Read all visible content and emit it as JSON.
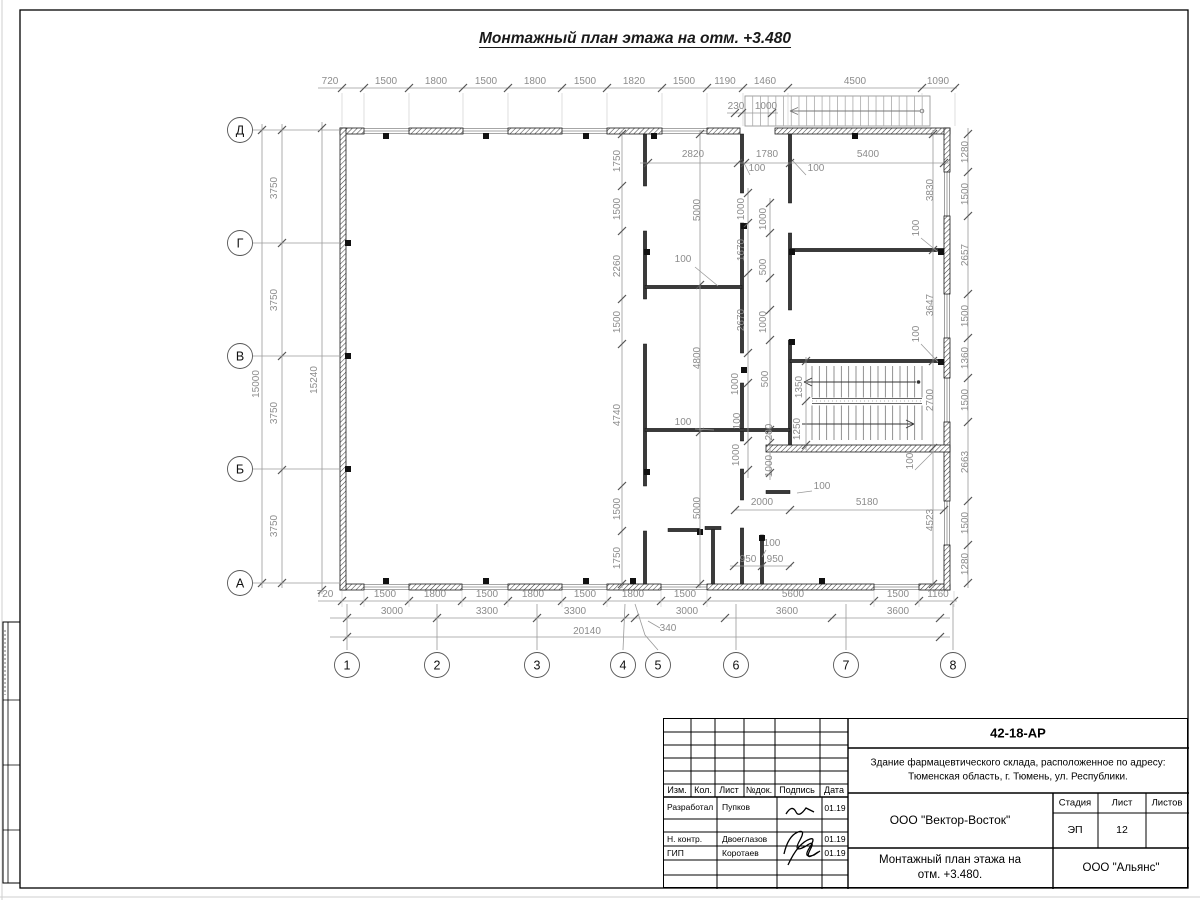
{
  "meta": {
    "title": "Монтажный план этажа на отм. +3.480"
  },
  "titleblock": {
    "code": "42-18-АР",
    "object1": "Здание фармацевтического склада, расположенное по адресу:",
    "object2": "Тюменская область, г. Тюмень, ул. Республики.",
    "cols": [
      "Изм.",
      "Кол.",
      "Лист",
      "№док.",
      "Подпись",
      "Дата"
    ],
    "sign_rows": [
      {
        "role": "Разработал",
        "name": "Пупков",
        "date": "01.19"
      },
      {
        "role": "Н. контр.",
        "name": "Двоеглазов",
        "date": "01.19"
      },
      {
        "role": "ГИП",
        "name": "Коротаев",
        "date": "01.19"
      }
    ],
    "org": "ООО \"Вектор-Восток\"",
    "stage_label": "Стадия",
    "sheet_label": "Лист",
    "sheets_label": "Листов",
    "stage": "ЭП",
    "sheet": "12",
    "sheets": "",
    "name1": "Монтажный план этажа на",
    "name2": "отм. +3.480.",
    "company": "ООО \"Альянс\""
  },
  "plan": {
    "colors": {
      "wall": "#1a1a1a",
      "dim": "#8c8c8c",
      "line": "#9a9a9a",
      "tick": "#555555",
      "thin": "#888888"
    },
    "frame": {
      "x": 20,
      "y": 10,
      "w": 1168,
      "h": 878
    },
    "ext_walls": [
      [
        340,
        128,
        24,
        6
      ],
      [
        409,
        128,
        54,
        6
      ],
      [
        508,
        128,
        54,
        6
      ],
      [
        607,
        128,
        55,
        6
      ],
      [
        707,
        128,
        33,
        6
      ],
      [
        775,
        128,
        175,
        6
      ],
      [
        340,
        584,
        24,
        6
      ],
      [
        409,
        584,
        53,
        6
      ],
      [
        508,
        584,
        54,
        6
      ],
      [
        607,
        584,
        54,
        6
      ],
      [
        707,
        584,
        167,
        6
      ],
      [
        919,
        584,
        31,
        6
      ],
      [
        340,
        128,
        6,
        462
      ],
      [
        944,
        128,
        6,
        44
      ],
      [
        944,
        216,
        6,
        78
      ],
      [
        944,
        338,
        6,
        40
      ],
      [
        944,
        422,
        6,
        79
      ],
      [
        944,
        545,
        6,
        45
      ],
      [
        766,
        445,
        184,
        7
      ]
    ],
    "windows": [
      [
        364,
        128,
        45,
        6,
        "h"
      ],
      [
        463,
        128,
        45,
        6,
        "h"
      ],
      [
        562,
        128,
        45,
        6,
        "h"
      ],
      [
        662,
        128,
        45,
        6,
        "h"
      ],
      [
        364,
        584,
        45,
        6,
        "h"
      ],
      [
        462,
        584,
        46,
        6,
        "h"
      ],
      [
        562,
        584,
        45,
        6,
        "h"
      ],
      [
        661,
        584,
        46,
        6,
        "h"
      ],
      [
        874,
        584,
        45,
        6,
        "h"
      ],
      [
        944,
        172,
        6,
        44,
        "v"
      ],
      [
        944,
        294,
        6,
        44,
        "v"
      ],
      [
        944,
        378,
        6,
        44,
        "v"
      ],
      [
        944,
        501,
        6,
        44,
        "v"
      ]
    ],
    "int_walls_v": [
      [
        645,
        134,
        186
      ],
      [
        645,
        231,
        299
      ],
      [
        645,
        344,
        486
      ],
      [
        645,
        531,
        584
      ],
      [
        742,
        134,
        193
      ],
      [
        742,
        223,
        353
      ],
      [
        742,
        383,
        441
      ],
      [
        742,
        469,
        500
      ],
      [
        742,
        528,
        584
      ],
      [
        790,
        134,
        203
      ],
      [
        790,
        233,
        310
      ],
      [
        790,
        340,
        445
      ],
      [
        713,
        528,
        584
      ],
      [
        762,
        535,
        584
      ]
    ],
    "int_walls_h": [
      [
        287,
        645,
        742
      ],
      [
        430,
        645,
        790
      ],
      [
        250,
        790,
        944
      ],
      [
        361,
        790,
        944
      ],
      [
        492,
        766,
        790
      ],
      [
        530,
        668,
        700
      ],
      [
        528,
        705,
        721
      ]
    ],
    "stubs": [
      [
        386,
        136
      ],
      [
        486,
        136
      ],
      [
        586,
        136
      ],
      [
        654,
        136
      ],
      [
        855,
        136
      ],
      [
        386,
        581
      ],
      [
        486,
        581
      ],
      [
        586,
        581
      ],
      [
        633,
        581
      ],
      [
        822,
        581
      ],
      [
        348,
        243
      ],
      [
        348,
        356
      ],
      [
        348,
        469
      ],
      [
        941,
        252
      ],
      [
        941,
        362
      ],
      [
        647,
        252
      ],
      [
        647,
        472
      ],
      [
        744,
        226
      ],
      [
        744,
        370
      ],
      [
        792,
        252
      ],
      [
        792,
        342
      ],
      [
        700,
        532
      ],
      [
        762,
        538
      ]
    ],
    "axis_rows": [
      [
        "Д",
        130
      ],
      [
        "Г",
        243
      ],
      [
        "В",
        356
      ],
      [
        "Б",
        469
      ],
      [
        "А",
        583
      ]
    ],
    "axis_cols": [
      [
        "1",
        347
      ],
      [
        "2",
        437
      ],
      [
        "3",
        537
      ],
      [
        "4",
        623
      ],
      [
        "5",
        658
      ],
      [
        "6",
        736
      ],
      [
        "7",
        846
      ],
      [
        "8",
        953
      ]
    ],
    "dims": [
      [
        "720",
        330,
        84
      ],
      [
        "1500",
        386,
        84
      ],
      [
        "1800",
        436,
        84
      ],
      [
        "1500",
        486,
        84
      ],
      [
        "1800",
        535,
        84
      ],
      [
        "1500",
        585,
        84
      ],
      [
        "1820",
        634,
        84
      ],
      [
        "1500",
        684,
        84
      ],
      [
        "1190",
        725,
        84
      ],
      [
        "1460",
        765,
        84
      ],
      [
        "4500",
        855,
        84
      ],
      [
        "1090",
        938,
        84
      ],
      [
        "230",
        736,
        109
      ],
      [
        "1000",
        766,
        109
      ],
      [
        "2820",
        693,
        157
      ],
      [
        "1780",
        767,
        157
      ],
      [
        "5400",
        868,
        157
      ],
      [
        "3750",
        277,
        188,
        1
      ],
      [
        "3750",
        277,
        300,
        1
      ],
      [
        "3750",
        277,
        413,
        1
      ],
      [
        "3750",
        277,
        526,
        1
      ],
      [
        "15000",
        259,
        384,
        1
      ],
      [
        "15240",
        317,
        380,
        1
      ],
      [
        "1750",
        620,
        161,
        1
      ],
      [
        "1500",
        620,
        209,
        1
      ],
      [
        "2260",
        620,
        266,
        1
      ],
      [
        "1500",
        620,
        322,
        1
      ],
      [
        "4740",
        620,
        415,
        1
      ],
      [
        "1500",
        620,
        509,
        1
      ],
      [
        "1750",
        620,
        558,
        1
      ],
      [
        "5000",
        700,
        210,
        1
      ],
      [
        "4800",
        700,
        358,
        1
      ],
      [
        "5000",
        700,
        508,
        1
      ],
      [
        "1000",
        744,
        209,
        1
      ],
      [
        "1000",
        766,
        219,
        1
      ],
      [
        "1670",
        744,
        250,
        1
      ],
      [
        "500",
        766,
        267,
        1
      ],
      [
        "2670",
        744,
        320,
        1
      ],
      [
        "1000",
        766,
        322,
        1
      ],
      [
        "1000",
        738,
        384,
        1
      ],
      [
        "500",
        768,
        379,
        1
      ],
      [
        "100",
        740,
        421,
        1
      ],
      [
        "200",
        772,
        432,
        1
      ],
      [
        "1000",
        739,
        455,
        1
      ],
      [
        "1000",
        772,
        466,
        1
      ],
      [
        "1350",
        802,
        387,
        1
      ],
      [
        "1250",
        800,
        429,
        1
      ],
      [
        "3830",
        933,
        190,
        1
      ],
      [
        "3647",
        933,
        305,
        1
      ],
      [
        "2700",
        933,
        400,
        1
      ],
      [
        "4523",
        933,
        520,
        1
      ],
      [
        "1280",
        968,
        152,
        1
      ],
      [
        "1500",
        968,
        194,
        1
      ],
      [
        "2657",
        968,
        255,
        1
      ],
      [
        "1500",
        968,
        316,
        1
      ],
      [
        "1360",
        968,
        358,
        1
      ],
      [
        "1500",
        968,
        400,
        1
      ],
      [
        "2663",
        968,
        462,
        1
      ],
      [
        "1500",
        968,
        523,
        1
      ],
      [
        "1280",
        968,
        564,
        1
      ],
      [
        "2000",
        762,
        505
      ],
      [
        "5180",
        867,
        505
      ],
      [
        "950",
        748,
        562
      ],
      [
        "950",
        775,
        562
      ],
      [
        "720",
        325,
        597
      ],
      [
        "1500",
        385,
        597
      ],
      [
        "1800",
        435,
        597
      ],
      [
        "1500",
        487,
        597
      ],
      [
        "1800",
        533,
        597
      ],
      [
        "1500",
        585,
        597
      ],
      [
        "1800",
        633,
        597
      ],
      [
        "1500",
        685,
        597
      ],
      [
        "5600",
        793,
        597
      ],
      [
        "1500",
        898,
        597
      ],
      [
        "1160",
        938,
        597
      ],
      [
        "3000",
        392,
        614
      ],
      [
        "3300",
        487,
        614
      ],
      [
        "3300",
        575,
        614
      ],
      [
        "340",
        668,
        631
      ],
      [
        "3000",
        687,
        614
      ],
      [
        "3600",
        787,
        614
      ],
      [
        "3600",
        898,
        614
      ],
      [
        "20140",
        587,
        634
      ],
      [
        "100",
        683,
        262
      ],
      [
        "100",
        683,
        425
      ],
      [
        "100",
        757,
        171
      ],
      [
        "100",
        816,
        171
      ],
      [
        "100",
        919,
        228,
        1
      ],
      [
        "100",
        919,
        334,
        1
      ],
      [
        "100",
        913,
        461,
        1
      ],
      [
        "100",
        822,
        489
      ],
      [
        "100",
        772,
        546
      ]
    ],
    "chains_h": [
      [
        88,
        318,
        957,
        [
          342,
          364,
          409,
          463,
          508,
          562,
          607,
          662,
          707,
          743,
          788,
          922,
          955
        ],
        1
      ],
      [
        113,
        727,
        778,
        [
          735,
          742,
          772
        ],
        0
      ],
      [
        163,
        640,
        950,
        [
          648,
          738,
          745,
          790,
          944
        ],
        0
      ],
      [
        601,
        318,
        957,
        [
          342,
          364,
          409,
          462,
          508,
          562,
          607,
          661,
          707,
          874,
          919,
          954
        ],
        2
      ],
      [
        618,
        330,
        950,
        [
          347,
          437,
          537,
          625,
          635,
          725,
          832,
          940
        ],
        0
      ],
      [
        637,
        330,
        950,
        [
          347,
          940
        ],
        0
      ],
      [
        510,
        735,
        944,
        [
          735,
          790,
          944
        ],
        0
      ],
      [
        566,
        730,
        792,
        [
          734,
          762,
          790
        ],
        0
      ]
    ],
    "chains_v": [
      [
        282,
        124,
        588,
        [
          130,
          243,
          356,
          470,
          583
        ]
      ],
      [
        262,
        124,
        588,
        [
          130,
          583
        ]
      ],
      [
        322,
        122,
        594,
        [
          128,
          590
        ]
      ],
      [
        622,
        130,
        588,
        [
          134,
          186,
          231,
          299,
          344,
          486,
          531,
          584
        ]
      ],
      [
        700,
        130,
        588,
        [
          134,
          285,
          432,
          584
        ]
      ],
      [
        748,
        188,
        478,
        [
          193,
          223,
          273,
          353,
          383,
          441,
          470
        ]
      ],
      [
        770,
        198,
        480,
        [
          203,
          233,
          278,
          310,
          340,
          430,
          443,
          473
        ]
      ],
      [
        806,
        357,
        450,
        [
          361,
          401,
          445
        ]
      ],
      [
        968,
        128,
        588,
        [
          134,
          172,
          216,
          294,
          338,
          378,
          422,
          501,
          545,
          583
        ]
      ],
      [
        933,
        130,
        588,
        [
          134,
          250,
          361,
          448,
          584
        ]
      ]
    ],
    "leaders": [
      [
        695,
        267,
        718,
        286
      ],
      [
        695,
        429,
        714,
        430
      ],
      [
        750,
        175,
        743,
        161
      ],
      [
        806,
        175,
        793,
        161
      ],
      [
        921,
        238,
        938,
        252
      ],
      [
        921,
        344,
        938,
        362
      ],
      [
        915,
        470,
        933,
        452
      ],
      [
        812,
        491,
        797,
        493
      ],
      [
        766,
        550,
        762,
        557
      ],
      [
        660,
        628,
        648,
        621
      ]
    ],
    "stairs_int": {
      "x0": 812,
      "x1": 922,
      "y0": 366,
      "y1": 440,
      "rail0": 398.5,
      "rail1": 403.5,
      "n": 15
    },
    "stairs_ext": {
      "x0": 745,
      "y0": 96,
      "x1": 930,
      "y1": 126,
      "n": 24
    }
  }
}
